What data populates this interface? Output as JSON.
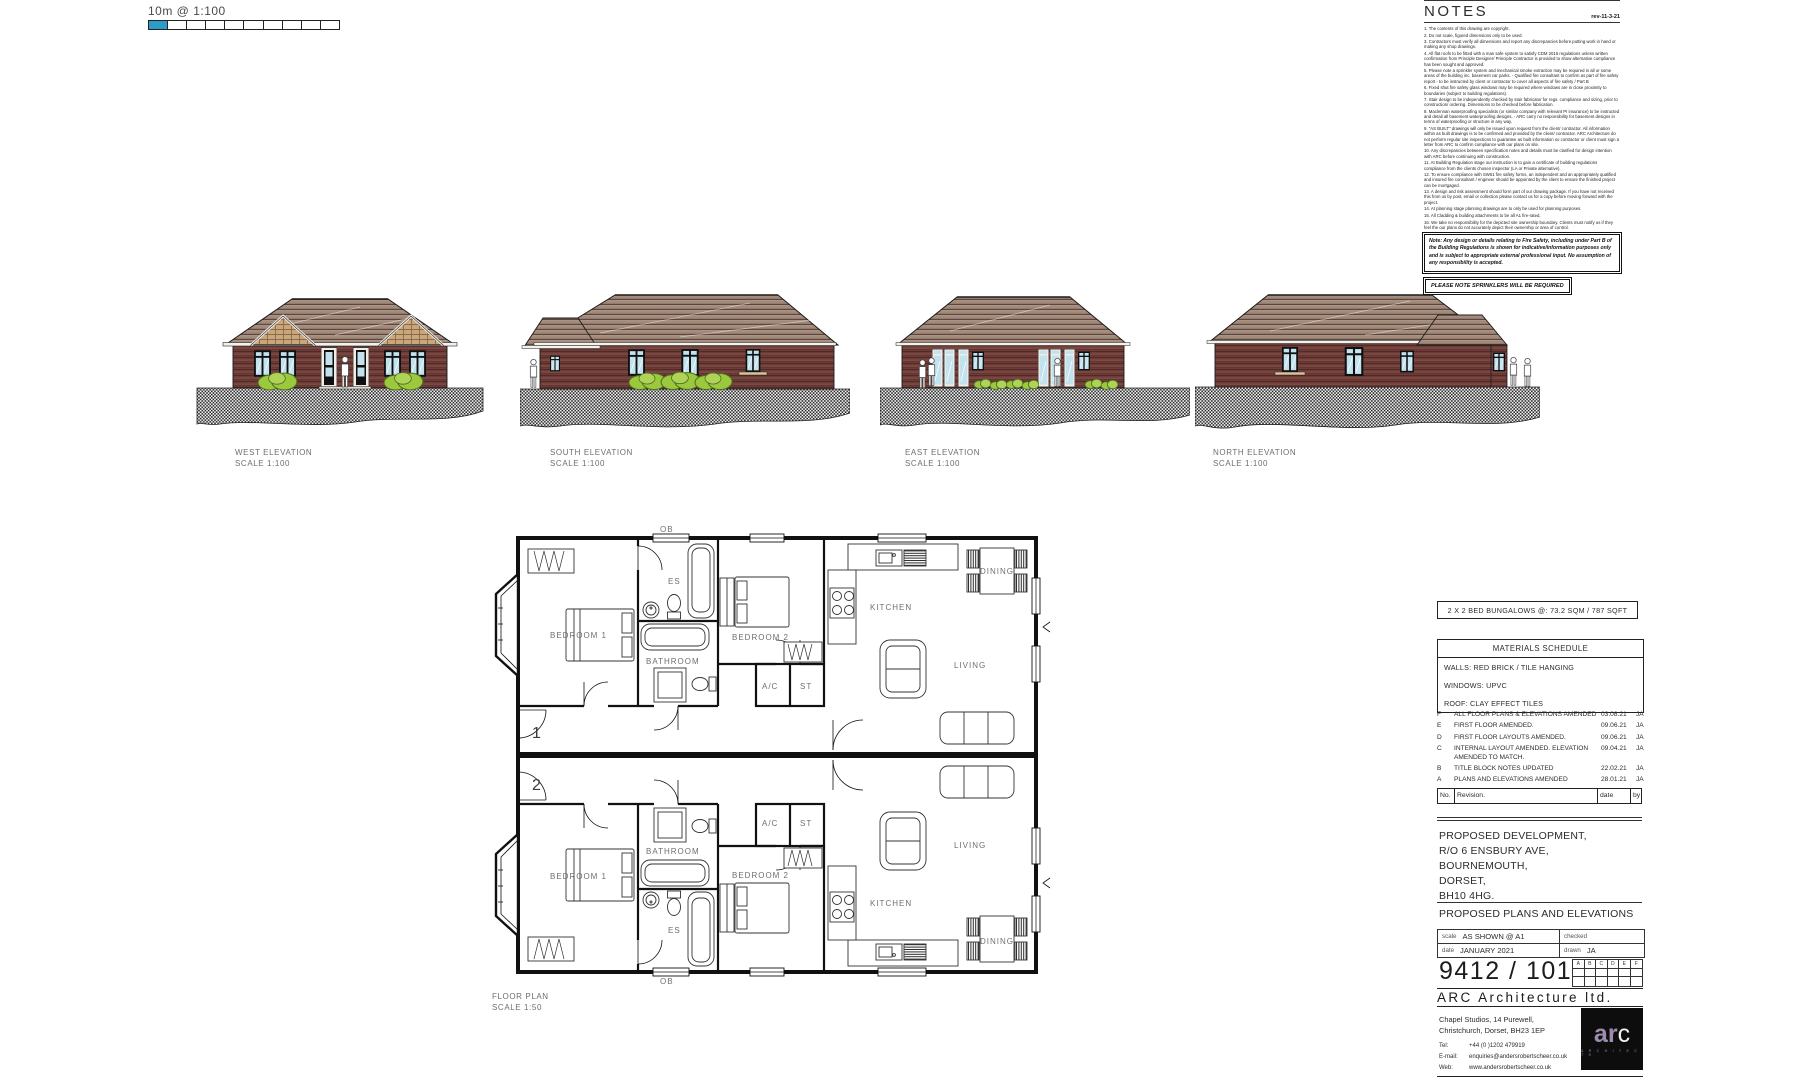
{
  "colors": {
    "scalebar_blue": "#2e9cc9",
    "roof_tan": "#ab9383",
    "brick_red": "#6e3c38",
    "tile_hanging": "#c8a87a",
    "glass_blue": "#c2e2ee",
    "bush_green": "#9cc83e",
    "logo_purple": "#9d8bb0"
  },
  "scalebar": {
    "label": "10m @ 1:100"
  },
  "notes": {
    "title": "NOTES",
    "rev": "rev-11-3-21",
    "items": [
      "1. The contents of this drawing are copyright.",
      "2. Do not scale, figured dimensions only to be used.",
      "3. Contractors must verify all dimensions and report any discrepancies before putting work in hand or making any shop drawings.",
      "4. All flat roofs to be fitted with a man safe system to satisfy CDM 2015 regulations unless written confirmation from Principle Designer/ Principle Contractor is provided to show alternative compliance has been sought and approved.",
      "5. Please note a sprinkler system and mechanical smoke extraction may be required in all or some areas of the building inc. basement car parks. - Qualified fire consultant to confirm as part of fire safety report - to be instructed by client or contractor to cover all aspects of fire safety / Part B",
      "6. Fixed shut fire safety glass windows may be required where windows are in close proximity to boundaries (subject to building regulations).",
      "7. Stair design to be independently checked by stair fabricator for regs. compliance and sizing, prior to construction/ ordering. Dimensions to be checked before fabrication.",
      "8. Maclennan waterproofing specialists (or similar company with relevant PI insurance) to be instructed and detail all basement waterproofing designs. - ARC carry no responsibility for basement designs in terms of waterproofing or structure in any way.",
      "9. \"AS BUILT\" drawings will only be issued upon request from the client/ contractor. All information within as built drawings is to be confirmed and provided by the client/ contractor. ARC Architecture do not perform regular site inspections to guarantee as built information so contractor or client must sign a letter from ARC to confirm compliance with our plans on site.",
      "10. Any discrepancies between specification notes and details must be clarified for design intention with ARC before continuing with construction.",
      "11. At Building Regulation stage our instruction is to gain a certificate of building regulations compliance from the clients chosen inspector (LA or Private alternative).",
      "12. To ensure compliance with SW51 fire safety forms, an independent and an appropriately qualified and insured fire consultant / engineer should be appointed by the client to ensure the finished project can be mortgaged.",
      "13. A design and risk assessment should form part of our drawing package. If you have not received this from us by post, email or collection please contact us for a copy before moving forward with the project.",
      "14. At planning stage planning drawings are to only be used for planning purposes.",
      "15. All Cladding & building attachments to be all A1 fire-rated.",
      "16. We take no responsibility for the depicted site ownership boundary. Clients must notify us if they feel the our plans do not accurately depict their ownership or area of control."
    ],
    "fire_note": "Note: Any design or details relating to Fire Safety, including under Part B of the Building Regulations is shown for indicative/information purposes only and is subject to appropriate external professional input. No assumption of any responsibility is accepted.",
    "sprinkler_note": "PLEASE NOTE SPRINKLERS WILL BE REQUIRED"
  },
  "elevations": [
    {
      "label": "WEST ELEVATION",
      "scale": "SCALE 1:100"
    },
    {
      "label": "SOUTH ELEVATION",
      "scale": "SCALE 1:100"
    },
    {
      "label": "EAST ELEVATION",
      "scale": "SCALE 1:100"
    },
    {
      "label": "NORTH ELEVATION",
      "scale": "SCALE 1:100"
    }
  ],
  "floor_plan": {
    "label": "FLOOR PLAN",
    "scale": "SCALE 1:50",
    "unit1": {
      "number": "1",
      "ob": "OB",
      "bedroom1": "BEDROOM 1",
      "bedroom2": "BEDROOM 2",
      "bathroom": "BATHROOM",
      "ensuite": "ES",
      "ac": "A/C",
      "store": "ST",
      "kitchen": "KITCHEN",
      "living": "LIVING",
      "dining": "DINING"
    },
    "unit2": {
      "number": "2",
      "ob": "OB",
      "bedroom1": "BEDROOM 1",
      "bedroom2": "BEDROOM 2",
      "bathroom": "BATHROOM",
      "ensuite": "ES",
      "ac": "A/C",
      "store": "ST",
      "kitchen": "KITCHEN",
      "living": "LIVING",
      "dining": "DINING"
    }
  },
  "title_block": {
    "banner": "2 X 2 BED BUNGALOWS @: 73.2 SQM / 787 SQFT",
    "materials": {
      "title": "MATERIALS SCHEDULE",
      "rows": [
        "WALLS: RED BRICK  / TILE HANGING",
        "WINDOWS: UPVC",
        "ROOF: CLAY EFFECT TILES"
      ]
    },
    "revisions": {
      "header": {
        "no": "No.",
        "revision": "Revision.",
        "date": "date",
        "by": "by"
      },
      "rows": [
        {
          "no": "F",
          "revision": "ALL FLOOR PLANS & ELEVATIONS AMENDED",
          "date": "03.08.21",
          "by": "JA"
        },
        {
          "no": "E",
          "revision": "FIRST FLOOR AMENDED.",
          "date": "09.06.21",
          "by": "JA"
        },
        {
          "no": "D",
          "revision": "FIRST FLOOR LAYOUTS AMENDED.",
          "date": "09.06.21",
          "by": "JA"
        },
        {
          "no": "C",
          "revision": "INTERNAL LAYOUT AMENDED. ELEVATION AMENDED TO MATCH.",
          "date": "09.04.21",
          "by": "JA"
        },
        {
          "no": "B",
          "revision": "TITLE BLOCK NOTES UPDATED",
          "date": "22.02.21",
          "by": "JA"
        },
        {
          "no": "A",
          "revision": "PLANS AND ELEVATIONS AMENDED",
          "date": "28.01.21",
          "by": "JA"
        }
      ]
    },
    "project": [
      "PROPOSED DEVELOPMENT,",
      "R/O 6 ENSBURY AVE,",
      "BOURNEMOUTH,",
      "DORSET,",
      "BH10 4HG."
    ],
    "drawing_title": "PROPOSED PLANS AND ELEVATIONS",
    "meta": {
      "scale_label": "scale",
      "scale": "AS SHOWN @ A1",
      "checked_label": "checked",
      "date_label": "date",
      "date": "JANUARY 2021",
      "drawn_label": "drawn",
      "drawn": "JA"
    },
    "drawing_number": "9412 / 101",
    "rev_grid": [
      "A",
      "B",
      "C",
      "D",
      "E",
      "F"
    ],
    "firm": {
      "name": "ARC Architecture ltd.",
      "address1": "Chapel Studios, 14 Purewell,",
      "address2": "Christchurch, Dorset, BH23 1EP",
      "tel_label": "Tel:",
      "tel": "+44 (0 )1202 479919",
      "email_label": "E-mail:",
      "email": "enquiries@andersrobertscheer.co.uk",
      "web_label": "Web:",
      "web": "www.andersrobertscheer.co.uk",
      "logo_ar": "ar",
      "logo_c": "c",
      "logo_sub": "A R C H I T E C T S"
    }
  }
}
